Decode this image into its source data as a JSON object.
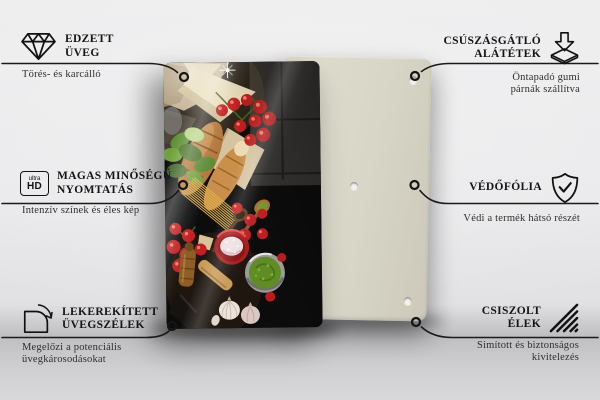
{
  "page": {
    "background": "#e9e9ea"
  },
  "product": {
    "back_panel": {
      "color": "#d8d6c7",
      "holes_visible": 3
    },
    "glass_panel": {
      "color": "#0c0c0c",
      "photo": "italian-food-flatlay"
    }
  },
  "callouts": [
    {
      "id": "tempered-glass",
      "side": "left",
      "icon": "diamond-icon",
      "title_lines": [
        "EDZETT",
        "ÜVEG"
      ],
      "subtitle_lines": [
        "Törés- és karcálló"
      ]
    },
    {
      "id": "anti-slip-pads",
      "side": "right",
      "icon": "anti-slip-pads-icon",
      "title_lines": [
        "CSÚSZÁSGÁTLÓ",
        "ALÁTÉTEK"
      ],
      "subtitle_lines": [
        "Öntapadó gumi",
        "párnák szállítva"
      ]
    },
    {
      "id": "high-quality-print",
      "side": "left",
      "icon": "ultra-hd-icon",
      "icon_text": [
        "ultra",
        "HD"
      ],
      "title_lines": [
        "MAGAS MINŐSÉGŰ",
        "NYOMTATÁS"
      ],
      "subtitle_lines": [
        "Intenzív színek és éles kép"
      ]
    },
    {
      "id": "protective-film",
      "side": "right",
      "icon": "shield-check-icon",
      "title_lines": [
        "VÉDŐFÓLIA"
      ],
      "subtitle_lines": [
        "Védi a termék hátsó részét"
      ]
    },
    {
      "id": "rounded-glass-edges",
      "side": "left",
      "icon": "rounded-corner-icon",
      "title_lines": [
        "LEKEREKÍTETT",
        "ÜVEGSZÉLEK"
      ],
      "subtitle_lines": [
        "Megelőzi a potenciális",
        "üvegkárosodásokat"
      ]
    },
    {
      "id": "polished-edges",
      "side": "right",
      "icon": "polished-edges-icon",
      "title_lines": [
        "CSISZOLT",
        "ÉLEK"
      ],
      "subtitle_lines": [
        "Simított és biztonságos",
        "kivitelezés"
      ]
    }
  ],
  "colors": {
    "leader_line": "#1a1a1a",
    "title_text": "#141414",
    "subtitle_text": "#2e2e2e",
    "panel_beige": "#d8d6c7",
    "tomato_red": "#c0201f",
    "pesto_green": "#5f8c23",
    "bread_brown": "#b27436"
  }
}
